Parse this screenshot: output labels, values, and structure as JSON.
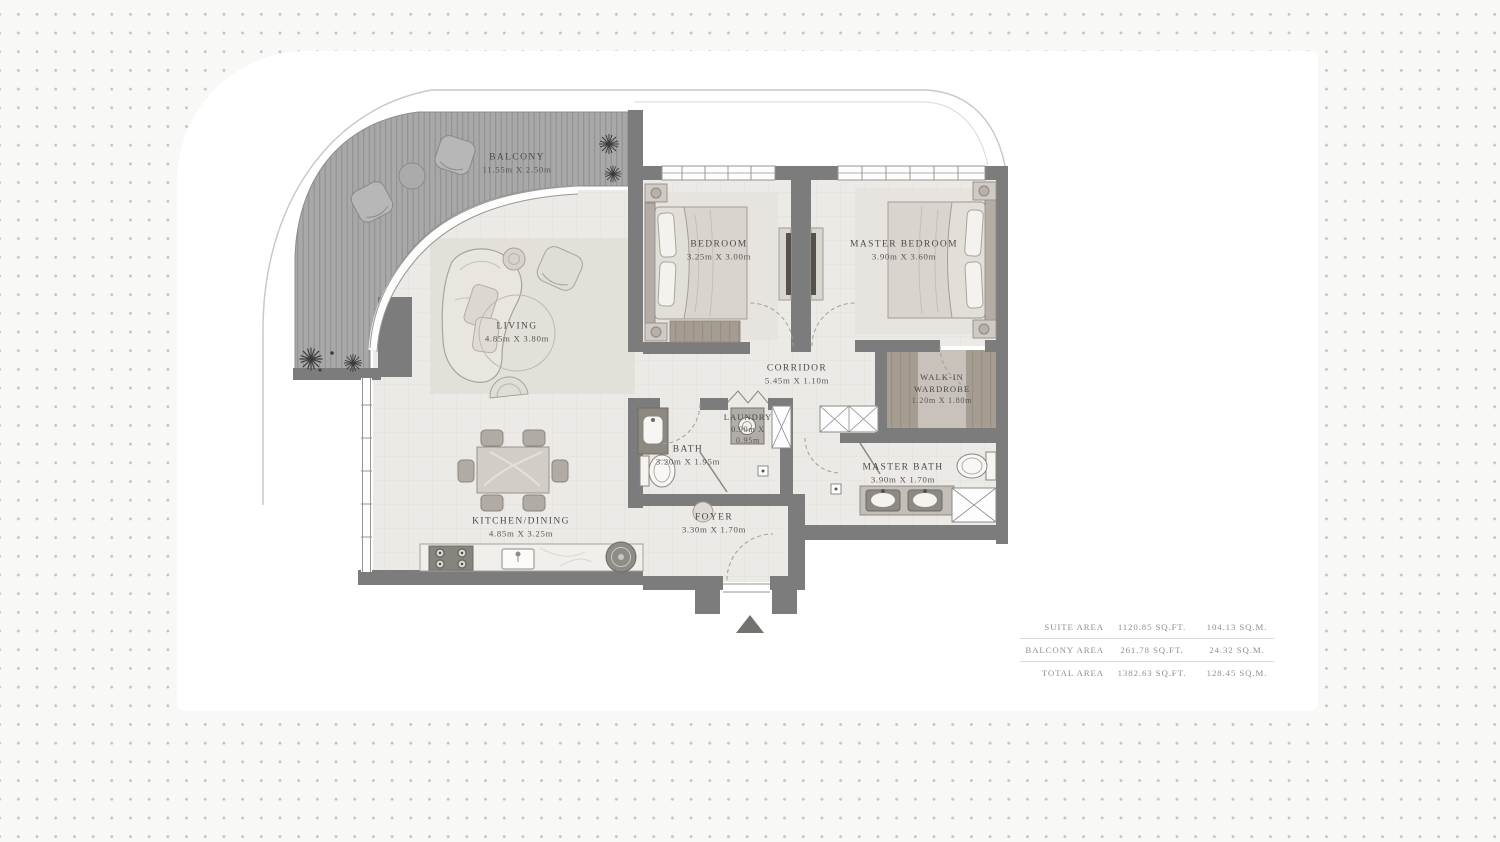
{
  "plan": {
    "title": "apartment-floor-plan",
    "rooms": {
      "balcony": {
        "name": "BALCONY",
        "dims": "11.55m X 2.50m"
      },
      "bedroom": {
        "name": "BEDROOM",
        "dims": "3.25m X 3.00m"
      },
      "master_bedroom": {
        "name": "MASTER BEDROOM",
        "dims": "3.90m X 3.60m"
      },
      "living": {
        "name": "LIVING",
        "dims": "4.85m X 3.80m"
      },
      "corridor": {
        "name": "CORRIDOR",
        "dims": "5.45m X 1.10m"
      },
      "walk_in_wardrobe": {
        "name_line1": "WALK-IN",
        "name_line2": "WARDROBE",
        "dims": "1.20m X 1.80m"
      },
      "laundry": {
        "name": "LAUNDRY",
        "dims_line1": "0.90m X",
        "dims_line2": "0.95m"
      },
      "bath": {
        "name": "BATH",
        "dims": "3.20m X 1.95m"
      },
      "master_bath": {
        "name": "MASTER BATH",
        "dims": "3.90m X 1.70m"
      },
      "kitchen_dining": {
        "name": "KITCHEN/DINING",
        "dims": "4.85m X 3.25m"
      },
      "foyer": {
        "name": "FOYER",
        "dims": "3.30m X 1.70m"
      }
    },
    "icons": {
      "entrance_arrow": "entrance-arrow-icon",
      "plants": "plant-icon",
      "door_swings": "door-swing-arc"
    },
    "colors": {
      "wall": "#7c7c7c",
      "deck": "#a8a8a8",
      "floor": "#eceae6",
      "fixture": "#f8f7f5",
      "text": "#4a4a4a"
    }
  },
  "area_table": {
    "rows": [
      {
        "label": "SUITE AREA",
        "sqft": "1120.85 SQ.FT.",
        "sqm": "104.13 SQ.M."
      },
      {
        "label": "BALCONY AREA",
        "sqft": "261.78 SQ.FT.",
        "sqm": "24.32 SQ.M."
      },
      {
        "label": "TOTAL AREA",
        "sqft": "1382.63 SQ.FT.",
        "sqm": "128.45 SQ.M."
      }
    ]
  }
}
